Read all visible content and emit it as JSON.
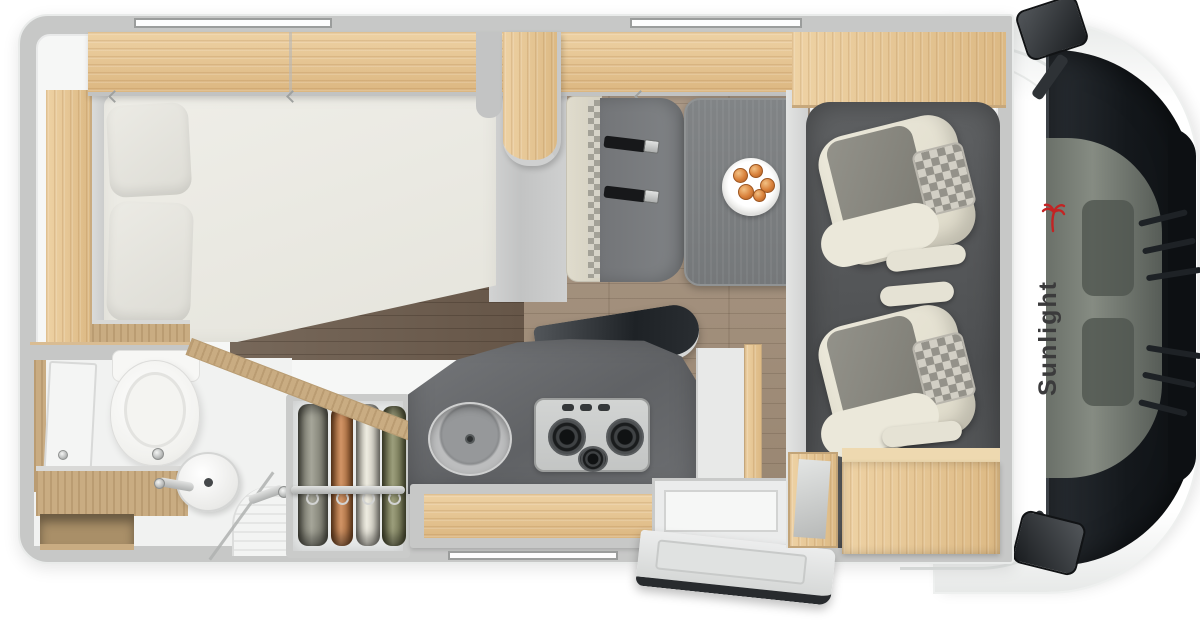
{
  "scene": {
    "kind": "motorhome-floor-plan-top-view",
    "visible_text_count": 1
  },
  "branding": {
    "logo_text": "Sunlight",
    "logo_text_color": "#3b3b3c",
    "logo_icon": "red-palm-icon",
    "logo_icon_color": "#c32323"
  },
  "palette": {
    "background": "#ffffff",
    "wall_grey": "#c7c8c7",
    "interior_white": "#f6f7f6",
    "wood_light": "#e4c495",
    "wood_tan": "#c9ac82",
    "floor_main": "#a4917e",
    "floor_bed_area": "#6e6053",
    "kitchen_counter": "#6c6e70",
    "dinette_table": "#7c7f81",
    "bench_grey": "#797c7f",
    "seat_cream": "#e7e4d6",
    "seat_grey": "#85847c",
    "cab_floor": "#55575a",
    "windshield": "#161a1e",
    "cloth_olive_grey": "#8d8d7d",
    "cloth_orange": "#c4763b",
    "cloth_cream": "#e9e6d8",
    "cloth_green": "#7f8256"
  },
  "regions": [
    {
      "id": "french-bed",
      "desc": "mattress with two pillows, angled foot corner"
    },
    {
      "id": "overhead-cabinets",
      "desc": "wood lockers along top wall with swivel TV panel"
    },
    {
      "id": "bathroom",
      "desc": "toilet, washbasin with faucet, wood vanity, shower tray, door panel"
    },
    {
      "id": "wardrobe",
      "desc": "four garments hanging on rail"
    },
    {
      "id": "kitchen",
      "desc": "dark worktop, round sink, three-burner hob with raised lid, wood drawer front"
    },
    {
      "id": "dinette",
      "desc": "bench with two seatbelts facing grey table"
    },
    {
      "id": "fruit-plate",
      "desc": "white plate with five fruits on table"
    },
    {
      "id": "cab-seats",
      "desc": "two swivel captain chairs with checkered headrests"
    },
    {
      "id": "entry-door",
      "desc": "open entrance door at bottom"
    },
    {
      "id": "cab",
      "desc": "driver cab, windshield, two exterior mirrors, hood vents"
    },
    {
      "id": "windows",
      "desc": "three wall window slots (two top, one bottom)"
    }
  ]
}
